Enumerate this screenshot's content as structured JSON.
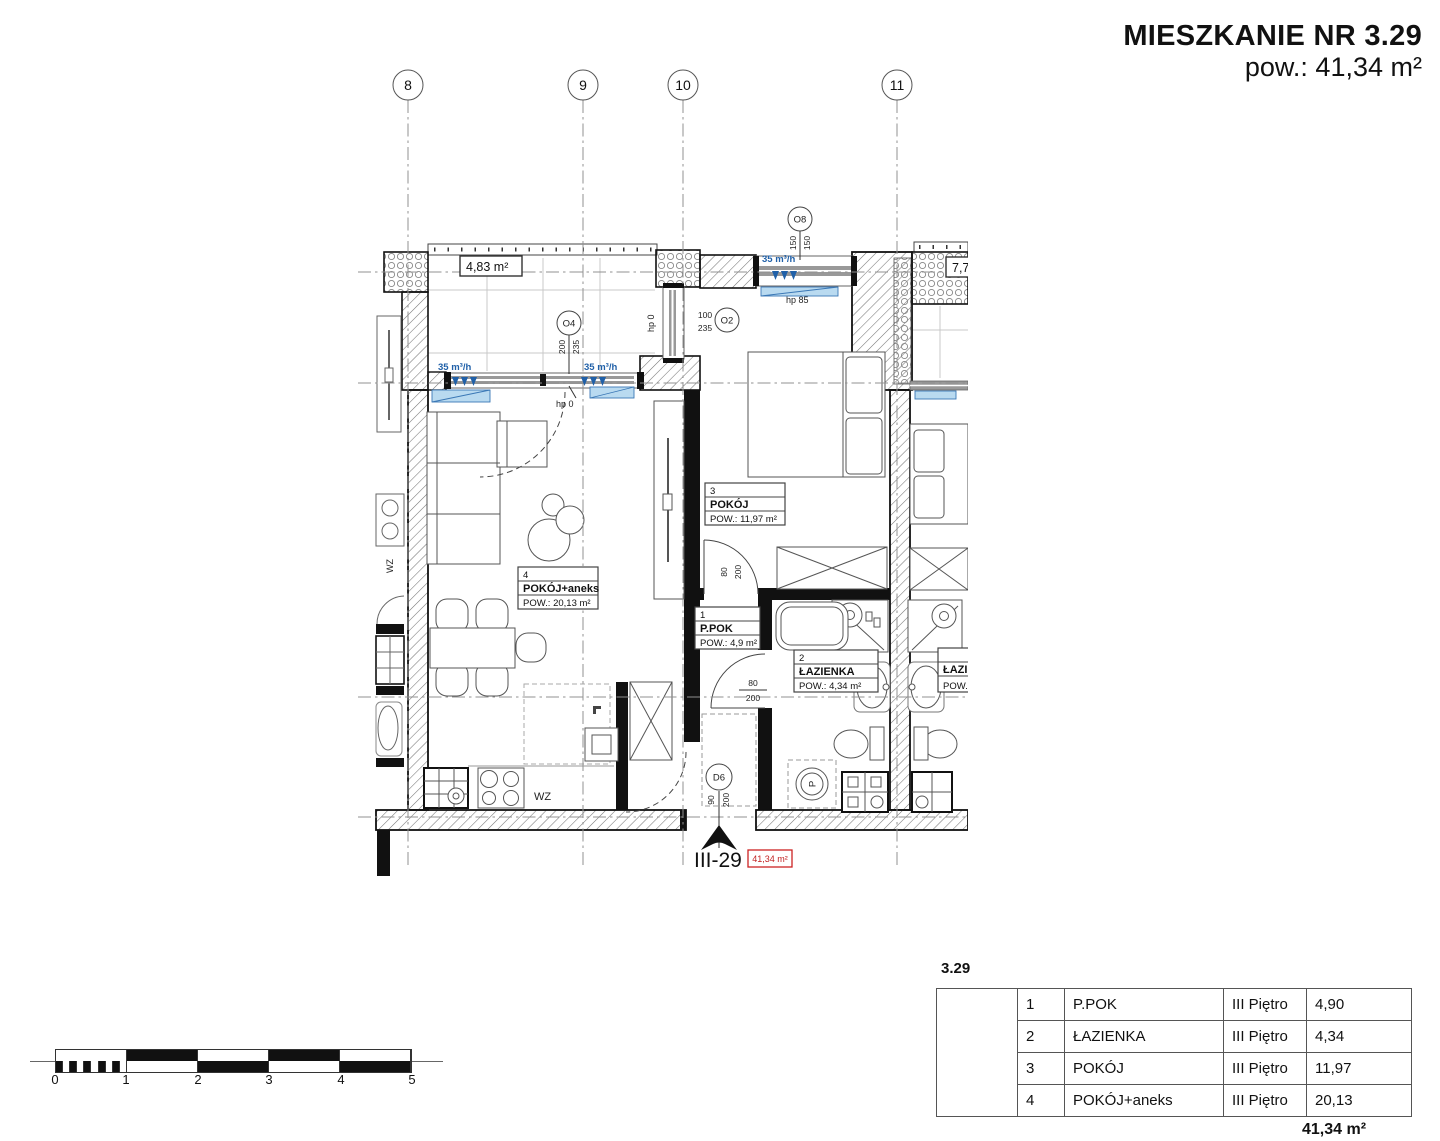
{
  "header": {
    "title": "MIESZKANIE NR 3.29",
    "subtitle": "pow.: 41,34 m²"
  },
  "grid": {
    "b1": "8",
    "b2": "9",
    "b3": "10",
    "b4": "11"
  },
  "plan": {
    "balcony_area": "4,83 m²",
    "neighbor_balcony_area": "7,7",
    "vent1": "35 m³/h",
    "vent2": "35 m³/h",
    "vent3": "35 m³/h",
    "o4": {
      "id": "O4",
      "w": "200",
      "h": "235",
      "hp": "hp 0"
    },
    "o2": {
      "id": "O2",
      "w": "100",
      "h": "235",
      "hp": "hp 0"
    },
    "o8": {
      "id": "O8",
      "w": "150",
      "h": "150",
      "hp": "hp 85"
    },
    "d6": {
      "id": "D6",
      "w": "90",
      "h": "200"
    },
    "bedroom_door": {
      "w": "80",
      "h": "200"
    },
    "bathroom_door": {
      "w": "80",
      "h": "200"
    },
    "room4": {
      "num": "4",
      "name": "POKÓJ+aneks",
      "area": "POW.: 20,13 m²"
    },
    "room3": {
      "num": "3",
      "name": "POKÓJ",
      "area": "POW.: 11,97 m²"
    },
    "room1": {
      "num": "1",
      "name": "P.POK",
      "area": "POW.: 4,9 m²"
    },
    "room2": {
      "num": "2",
      "name": "ŁAZIENKA",
      "area": "POW.: 4,34 m²"
    },
    "neighbor_bath": {
      "name": "ŁAZIENKA",
      "area": "POW.:"
    },
    "kitchen_wz": "WZ",
    "neighbor_wz": "WZ",
    "kitchen_l": "L",
    "washer_label": "P",
    "entrance": {
      "unit": "III-29",
      "area": "41,34 m²"
    }
  },
  "table": {
    "caption": "3.29",
    "rows": [
      {
        "num": "1",
        "name": "P.POK",
        "floor": "III Piętro",
        "area": "4,90"
      },
      {
        "num": "2",
        "name": "ŁAZIENKA",
        "floor": "III Piętro",
        "area": "4,34"
      },
      {
        "num": "3",
        "name": "POKÓJ",
        "floor": "III Piętro",
        "area": "11,97"
      },
      {
        "num": "4",
        "name": "POKÓJ+aneks",
        "floor": "III Piętro",
        "area": "20,13"
      }
    ],
    "total": "41,34 m²"
  },
  "scalebar": {
    "labels": [
      "0",
      "1",
      "2",
      "3",
      "4",
      "5"
    ]
  }
}
